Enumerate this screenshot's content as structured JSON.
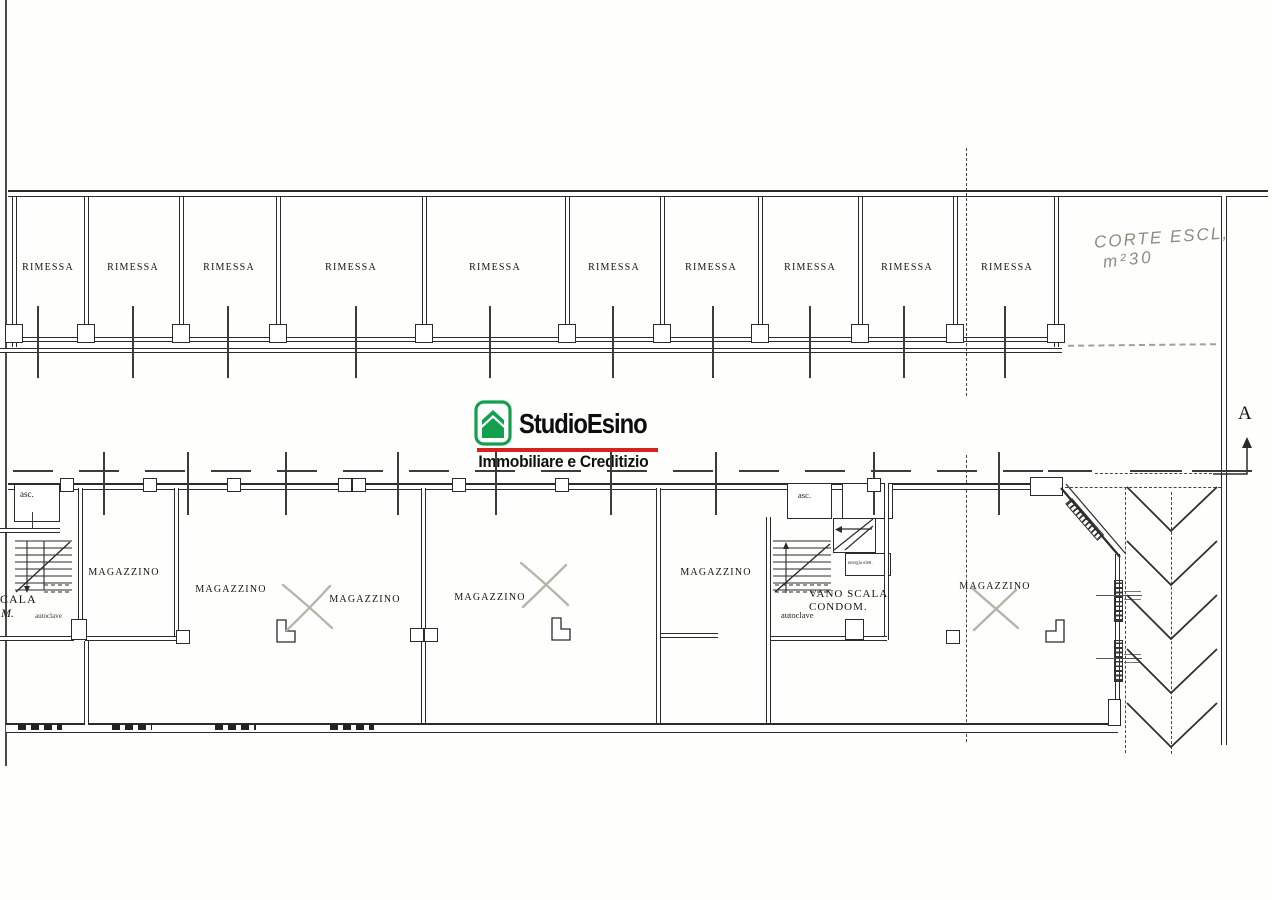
{
  "plan": {
    "garage_row": {
      "units": [
        {
          "label": "RIMESSA"
        },
        {
          "label": "RIMESSA"
        },
        {
          "label": "RIMESSA"
        },
        {
          "label": "RIMESSA"
        },
        {
          "label": "RIMESSA"
        },
        {
          "label": "RIMESSA"
        },
        {
          "label": "RIMESSA"
        },
        {
          "label": "RIMESSA"
        },
        {
          "label": "RIMESSA"
        },
        {
          "label": "RIMESSA"
        }
      ]
    },
    "courtyard_note": {
      "line1": "CORTE ESCL,",
      "line2": "m²30"
    },
    "section_marker": {
      "label": "A"
    },
    "lower_floor": {
      "rooms": [
        {
          "label": "MAGAZZINO"
        },
        {
          "label": "MAGAZZINO"
        },
        {
          "label": "MAGAZZINO"
        },
        {
          "label": "MAGAZZINO"
        },
        {
          "label": "MAGAZZINO"
        },
        {
          "label": "MAGAZZINO"
        }
      ],
      "stairwell": {
        "line1": "VANO SCALA",
        "line2": "CONDOM."
      },
      "elevator_left": {
        "label": "asc."
      },
      "elevator_right": {
        "label": "asc."
      },
      "autoclave_left": "autoclave",
      "autoclave_right": "autoclave",
      "energia_label": "energia elett.",
      "cut_text_line1": "CALA",
      "cut_text_line2": "M."
    }
  },
  "logo": {
    "brand": "StudioEsino",
    "tagline": "Immobiliare e Creditizio",
    "green": "#12A04F",
    "red": "#D6231F",
    "icon": "house-icon"
  }
}
